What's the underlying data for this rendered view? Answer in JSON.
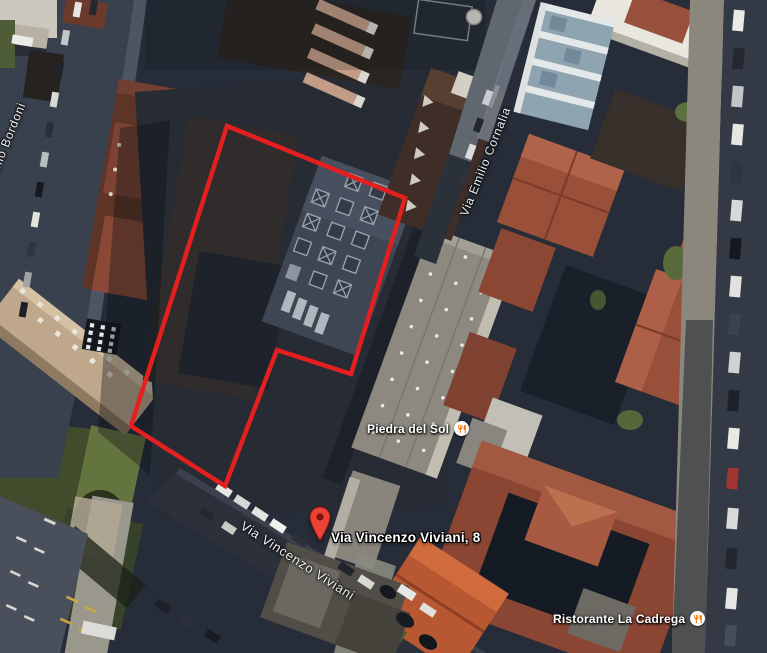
{
  "map": {
    "view": "satellite",
    "streets": {
      "bordoni": "Antonio Bordoni",
      "cornalia": "Via Emilio Cornalia",
      "viviani": "Via Vincenzo Viviani"
    },
    "marker": {
      "address": "Via Vincenzo Viviani, 8",
      "icon": "map-pin-icon"
    },
    "pois": [
      {
        "name": "Piedra del Sol",
        "icon": "restaurant-icon"
      },
      {
        "name": "Ristorante La Cadrega",
        "icon": "restaurant-icon"
      }
    ],
    "colors": {
      "property_outline": "#e3201f",
      "pin_fill": "#ea4335",
      "pin_stroke": "#8e1710",
      "pin_hole": "#7f100c",
      "poi_icon_glyph": "#ee7102"
    }
  }
}
